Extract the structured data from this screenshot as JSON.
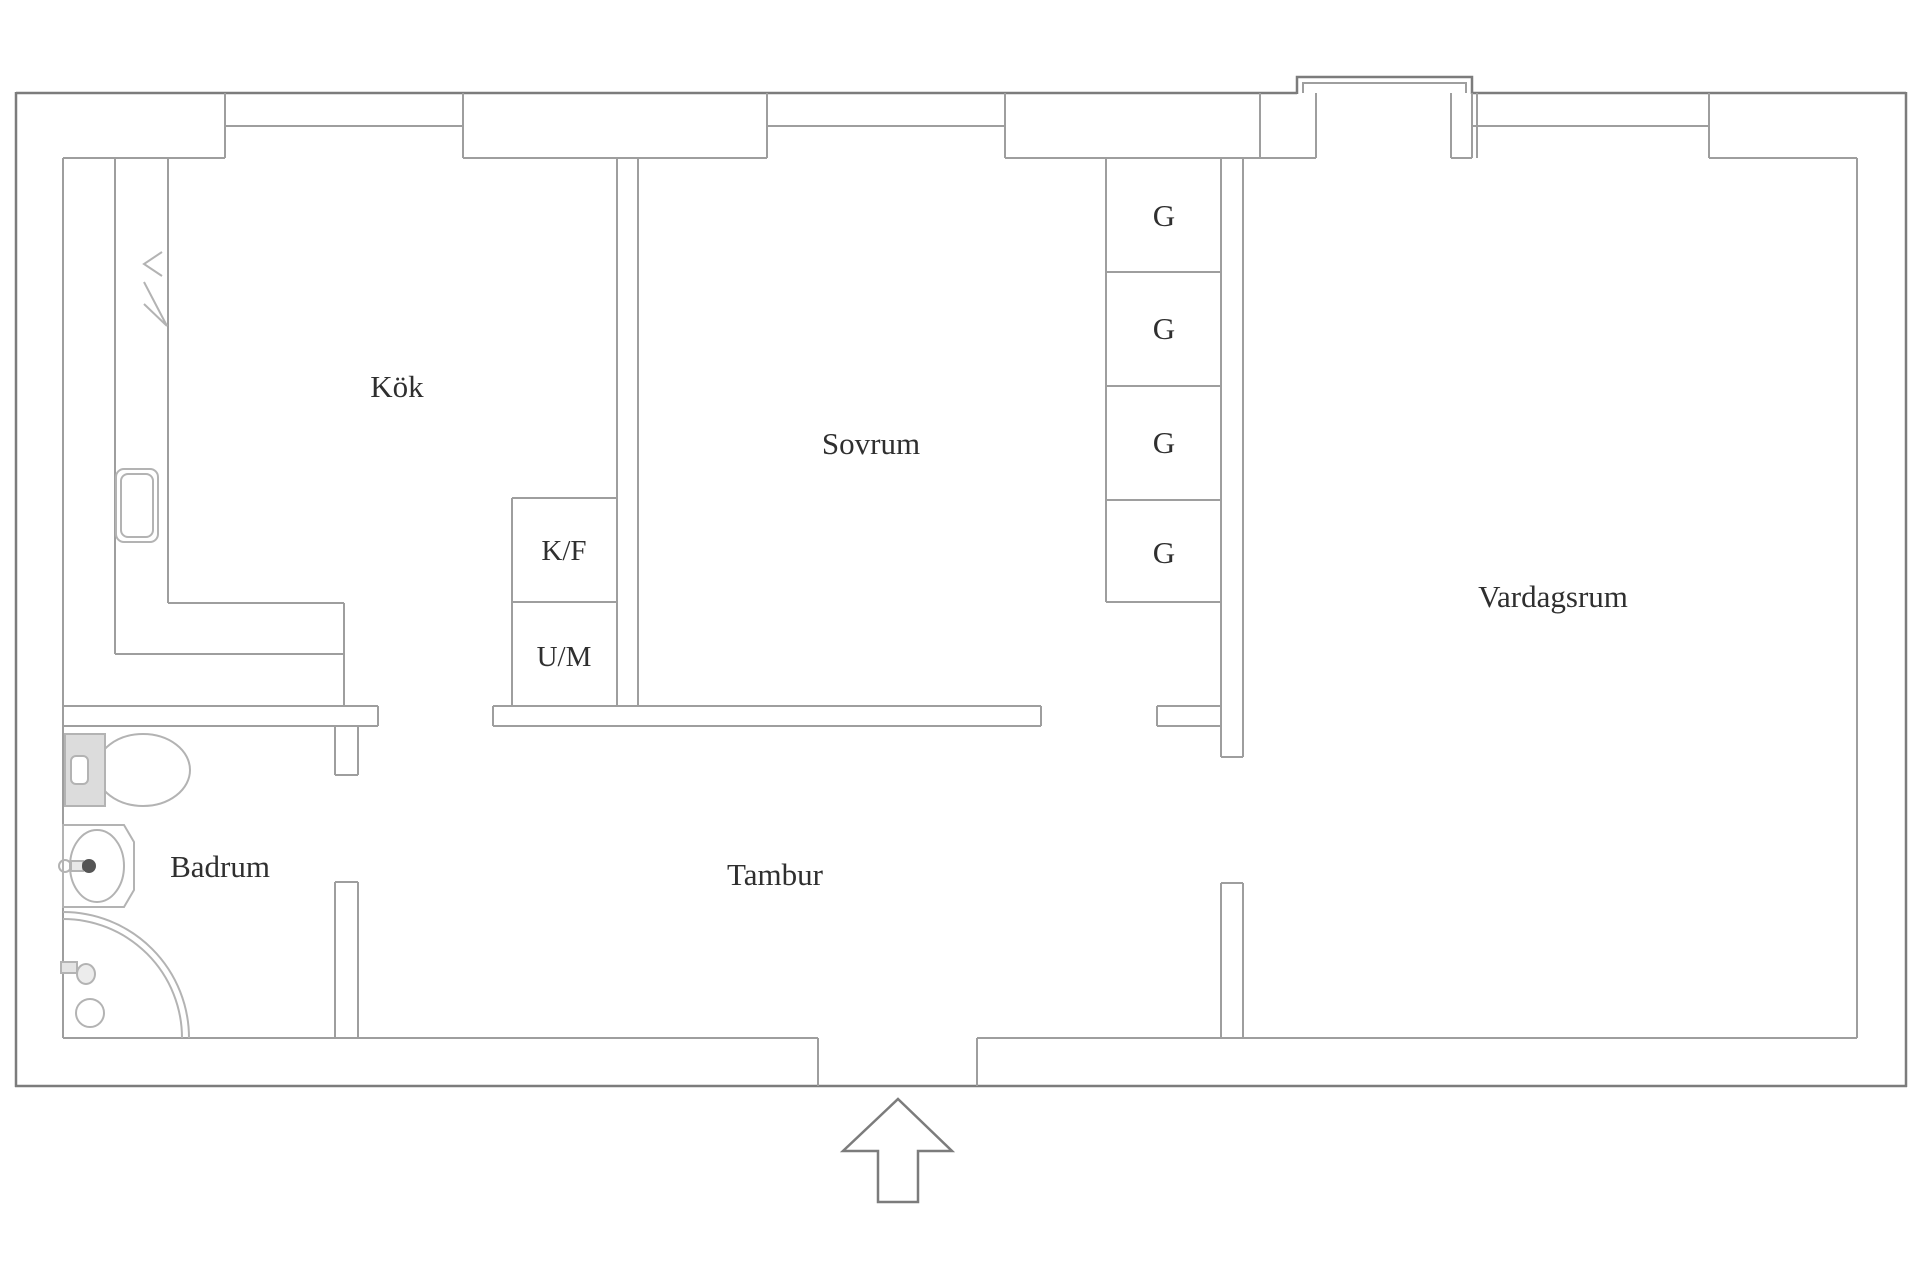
{
  "title": "Apartment floor plan",
  "rooms": {
    "kitchen": {
      "label": "Kök"
    },
    "bedroom": {
      "label": "Sovrum"
    },
    "living_room": {
      "label": "Vardagsrum"
    },
    "bathroom": {
      "label": "Badrum"
    },
    "hallway": {
      "label": "Tambur"
    }
  },
  "appliances": {
    "fridge_freezer": "K/F",
    "washing_machine": "U/M"
  },
  "wardrobes": [
    "G",
    "G",
    "G",
    "G"
  ],
  "symbols": {
    "entry_arrow": "arrow-up-icon",
    "window_count": 3
  },
  "colors": {
    "wall_outer": "#7c7c7c",
    "wall_inner": "#9e9e9e",
    "fixture": "#b3b3b3",
    "tank_fill": "#dcdcdc",
    "text": "#2f2f2f",
    "background": "#ffffff"
  }
}
